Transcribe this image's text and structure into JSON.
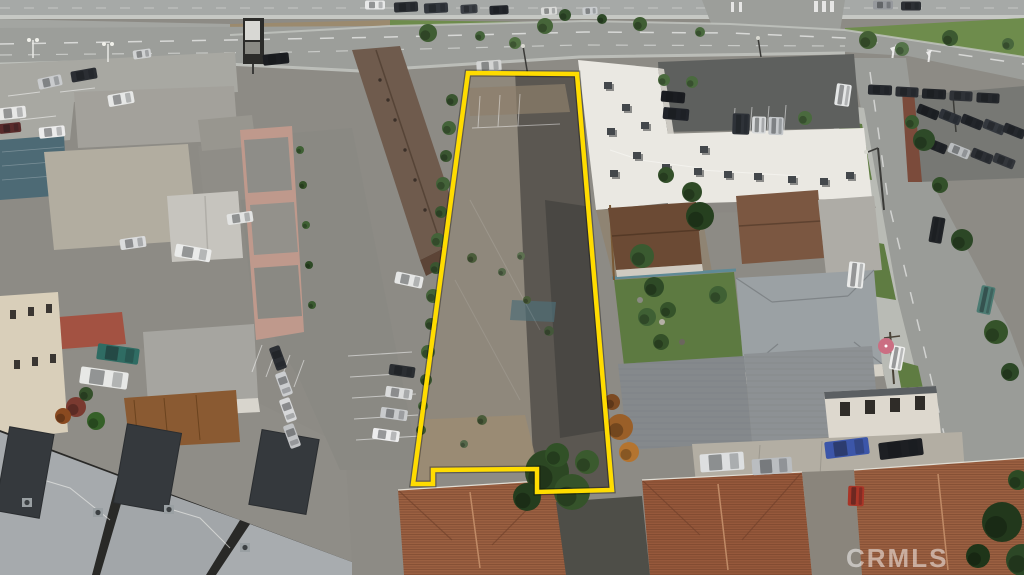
{
  "watermark": {
    "text": "CRMLS",
    "color": "#ffffff",
    "opacity": 0.5
  },
  "boundary": {
    "color": "#ffdc00",
    "width": 4.5,
    "points": "468,73 577,74 612,490 537,492 537,469 433,470 433,484 413,484"
  },
  "palette": {
    "boundary_yellow": "#ffdc00",
    "lot_surface": "#8f887c",
    "lot_dark_stain": "#55524c",
    "boulevard_asphalt": "#9c9e9a",
    "grass_green": "#6e8c4c",
    "white_roof": "#eae8e2",
    "tile_roof_terracotta": "#9b6041",
    "brown_apartment_roof": "#6f5b4d",
    "modern_roof_gray": "#a6aaad",
    "solar_panel_charcoal": "#35393d"
  },
  "scene": {
    "cars": [
      {
        "x": 375,
        "y": 5,
        "w": 20,
        "h": 9,
        "r": 0,
        "c": "#e7e8e8"
      },
      {
        "x": 406,
        "y": 7,
        "w": 24,
        "h": 10,
        "r": -3,
        "c": "#2b2e33"
      },
      {
        "x": 436,
        "y": 8,
        "w": 24,
        "h": 10,
        "r": -3,
        "c": "#33373d"
      },
      {
        "x": 469,
        "y": 9,
        "w": 17,
        "h": 9,
        "r": -3,
        "c": "#3c4046"
      },
      {
        "x": 499,
        "y": 10,
        "w": 19,
        "h": 9,
        "r": -3,
        "c": "#24272c"
      },
      {
        "x": 549,
        "y": 11,
        "w": 16,
        "h": 8,
        "r": -3,
        "c": "#d9dad8"
      },
      {
        "x": 590,
        "y": 11,
        "w": 15,
        "h": 8,
        "r": -3,
        "c": "#c9ccce"
      },
      {
        "x": 883,
        "y": 5,
        "w": 20,
        "h": 9,
        "r": 0,
        "c": "#96999d"
      },
      {
        "x": 911,
        "y": 6,
        "w": 20,
        "h": 9,
        "r": 0,
        "c": "#2d3035"
      },
      {
        "x": 50,
        "y": 82,
        "w": 24,
        "h": 11,
        "r": -12,
        "c": "#c9cbcd"
      },
      {
        "x": 84,
        "y": 75,
        "w": 26,
        "h": 11,
        "r": -10,
        "c": "#2b2e33"
      },
      {
        "x": 121,
        "y": 99,
        "w": 26,
        "h": 12,
        "r": -10,
        "c": "#e6e7e6"
      },
      {
        "x": 12,
        "y": 113,
        "w": 28,
        "h": 12,
        "r": -6,
        "c": "#e8e8e7"
      },
      {
        "x": 10,
        "y": 128,
        "w": 22,
        "h": 10,
        "r": -6,
        "c": "#5a2b2b"
      },
      {
        "x": 52,
        "y": 132,
        "w": 26,
        "h": 11,
        "r": -6,
        "c": "#ececec"
      },
      {
        "x": 142,
        "y": 54,
        "w": 18,
        "h": 9,
        "r": -8,
        "c": "#d0d2d3"
      },
      {
        "x": 276,
        "y": 59,
        "w": 26,
        "h": 11,
        "r": -6,
        "c": "#1b1d21"
      },
      {
        "x": 489,
        "y": 66,
        "w": 25,
        "h": 11,
        "r": -4,
        "c": "#d3d4d3"
      },
      {
        "x": 843,
        "y": 95,
        "w": 15,
        "h": 22,
        "r": 8,
        "c": "#e4e6e6"
      },
      {
        "x": 880,
        "y": 90,
        "w": 24,
        "h": 10,
        "r": 2,
        "c": "#26292e"
      },
      {
        "x": 907,
        "y": 92,
        "w": 23,
        "h": 10,
        "r": 3,
        "c": "#2b2e33"
      },
      {
        "x": 934,
        "y": 94,
        "w": 24,
        "h": 10,
        "r": 3,
        "c": "#222529"
      },
      {
        "x": 961,
        "y": 96,
        "w": 23,
        "h": 10,
        "r": 3,
        "c": "#2f3237"
      },
      {
        "x": 988,
        "y": 98,
        "w": 23,
        "h": 10,
        "r": 3,
        "c": "#25282c"
      },
      {
        "x": 928,
        "y": 112,
        "w": 22,
        "h": 10,
        "r": 22,
        "c": "#1e2125"
      },
      {
        "x": 950,
        "y": 117,
        "w": 22,
        "h": 10,
        "r": 22,
        "c": "#2e3238"
      },
      {
        "x": 972,
        "y": 122,
        "w": 22,
        "h": 10,
        "r": 22,
        "c": "#22252a"
      },
      {
        "x": 994,
        "y": 127,
        "w": 22,
        "h": 10,
        "r": 22,
        "c": "#34383e"
      },
      {
        "x": 1014,
        "y": 131,
        "w": 22,
        "h": 10,
        "r": 22,
        "c": "#25282d"
      },
      {
        "x": 936,
        "y": 146,
        "w": 22,
        "h": 10,
        "r": 22,
        "c": "#202327"
      },
      {
        "x": 959,
        "y": 151,
        "w": 22,
        "h": 10,
        "r": 22,
        "c": "#babdbf"
      },
      {
        "x": 982,
        "y": 156,
        "w": 22,
        "h": 10,
        "r": 22,
        "c": "#2c2f34"
      },
      {
        "x": 1004,
        "y": 161,
        "w": 22,
        "h": 10,
        "r": 22,
        "c": "#33363b"
      },
      {
        "x": 673,
        "y": 97,
        "w": 24,
        "h": 11,
        "r": 5,
        "c": "#1b1d21"
      },
      {
        "x": 676,
        "y": 114,
        "w": 26,
        "h": 12,
        "r": 5,
        "c": "#202329"
      },
      {
        "x": 741,
        "y": 124,
        "w": 17,
        "h": 21,
        "r": 2,
        "c": "#2e3238"
      },
      {
        "x": 759,
        "y": 125,
        "w": 14,
        "h": 17,
        "r": 2,
        "c": "#d8dadb"
      },
      {
        "x": 776,
        "y": 126,
        "w": 15,
        "h": 18,
        "r": 2,
        "c": "#c5c8cb"
      },
      {
        "x": 240,
        "y": 218,
        "w": 26,
        "h": 11,
        "r": -8,
        "c": "#e2e3e2"
      },
      {
        "x": 133,
        "y": 243,
        "w": 26,
        "h": 11,
        "r": -8,
        "c": "#dadbdc"
      },
      {
        "x": 193,
        "y": 253,
        "w": 36,
        "h": 13,
        "r": 10,
        "c": "#eaebea"
      },
      {
        "x": 409,
        "y": 280,
        "w": 28,
        "h": 12,
        "r": 12,
        "c": "#e5e6e5"
      },
      {
        "x": 402,
        "y": 371,
        "w": 26,
        "h": 11,
        "r": 8,
        "c": "#2b2e32"
      },
      {
        "x": 399,
        "y": 393,
        "w": 27,
        "h": 11,
        "r": 8,
        "c": "#dadbdb"
      },
      {
        "x": 394,
        "y": 414,
        "w": 27,
        "h": 11,
        "r": 8,
        "c": "#c8cacc"
      },
      {
        "x": 386,
        "y": 435,
        "w": 27,
        "h": 11,
        "r": 8,
        "c": "#ededee"
      },
      {
        "x": 118,
        "y": 354,
        "w": 42,
        "h": 16,
        "r": 8,
        "c": "#2f6c63"
      },
      {
        "x": 104,
        "y": 378,
        "w": 48,
        "h": 17,
        "r": 8,
        "c": "#e7e8e6"
      },
      {
        "x": 278,
        "y": 358,
        "w": 24,
        "h": 11,
        "r": 70,
        "c": "#2c2f34"
      },
      {
        "x": 284,
        "y": 384,
        "w": 24,
        "h": 11,
        "r": 70,
        "c": "#cbcdcf"
      },
      {
        "x": 288,
        "y": 410,
        "w": 24,
        "h": 11,
        "r": 70,
        "c": "#d7d8d9"
      },
      {
        "x": 292,
        "y": 436,
        "w": 24,
        "h": 11,
        "r": 70,
        "c": "#c0c2c4"
      },
      {
        "x": 937,
        "y": 230,
        "w": 13,
        "h": 26,
        "r": 10,
        "c": "#222528"
      },
      {
        "x": 986,
        "y": 300,
        "w": 14,
        "h": 28,
        "r": 12,
        "c": "#4c7b73"
      },
      {
        "x": 856,
        "y": 275,
        "w": 16,
        "h": 26,
        "r": 6,
        "c": "#e9eae9"
      },
      {
        "x": 897,
        "y": 358,
        "w": 13,
        "h": 24,
        "r": 10,
        "c": "#efefee"
      },
      {
        "x": 722,
        "y": 462,
        "w": 44,
        "h": 18,
        "r": -4,
        "c": "#dddfe0"
      },
      {
        "x": 772,
        "y": 466,
        "w": 40,
        "h": 16,
        "r": -4,
        "c": "#babdc0"
      },
      {
        "x": 847,
        "y": 448,
        "w": 44,
        "h": 17,
        "r": -7,
        "c": "#3c56a9"
      },
      {
        "x": 901,
        "y": 449,
        "w": 44,
        "h": 17,
        "r": -7,
        "c": "#1d1f23"
      },
      {
        "x": 856,
        "y": 496,
        "w": 16,
        "h": 20,
        "r": 2,
        "c": "#a93527"
      }
    ],
    "trees": [
      {
        "cx": 428,
        "cy": 33,
        "r": 9,
        "c": "#3f5d33"
      },
      {
        "cx": 545,
        "cy": 26,
        "r": 8,
        "c": "#466539"
      },
      {
        "cx": 515,
        "cy": 43,
        "r": 6,
        "c": "#527243"
      },
      {
        "cx": 640,
        "cy": 24,
        "r": 7,
        "c": "#3f5d33"
      },
      {
        "cx": 700,
        "cy": 32,
        "r": 5,
        "c": "#4a6a3e"
      },
      {
        "cx": 868,
        "cy": 40,
        "r": 9,
        "c": "#435f35"
      },
      {
        "cx": 902,
        "cy": 49,
        "r": 7,
        "c": "#55734a"
      },
      {
        "cx": 950,
        "cy": 38,
        "r": 8,
        "c": "#3c5931"
      },
      {
        "cx": 1008,
        "cy": 44,
        "r": 6,
        "c": "#48663c"
      },
      {
        "cx": 565,
        "cy": 15,
        "r": 6,
        "c": "#33502c"
      },
      {
        "cx": 602,
        "cy": 19,
        "r": 5,
        "c": "#2f4a28"
      },
      {
        "cx": 480,
        "cy": 36,
        "r": 5,
        "c": "#44633a"
      },
      {
        "cx": 452,
        "cy": 100,
        "r": 6,
        "c": "#3a5530"
      },
      {
        "cx": 449,
        "cy": 128,
        "r": 7,
        "c": "#446339"
      },
      {
        "cx": 446,
        "cy": 156,
        "r": 6,
        "c": "#3a5530"
      },
      {
        "cx": 443,
        "cy": 184,
        "r": 7,
        "c": "#446339"
      },
      {
        "cx": 441,
        "cy": 212,
        "r": 6,
        "c": "#3a5530"
      },
      {
        "cx": 438,
        "cy": 240,
        "r": 7,
        "c": "#446339"
      },
      {
        "cx": 436,
        "cy": 268,
        "r": 6,
        "c": "#3a5530"
      },
      {
        "cx": 433,
        "cy": 296,
        "r": 7,
        "c": "#446339"
      },
      {
        "cx": 431,
        "cy": 324,
        "r": 6,
        "c": "#3a5530"
      },
      {
        "cx": 428,
        "cy": 352,
        "r": 7,
        "c": "#446339"
      },
      {
        "cx": 426,
        "cy": 380,
        "r": 6,
        "c": "#3a5530"
      },
      {
        "cx": 423,
        "cy": 406,
        "r": 5,
        "c": "#446339"
      },
      {
        "cx": 421,
        "cy": 430,
        "r": 5,
        "c": "#3a5530"
      },
      {
        "cx": 472,
        "cy": 258,
        "r": 5,
        "c": "#4a5c3a"
      },
      {
        "cx": 502,
        "cy": 272,
        "r": 4,
        "c": "#55684a"
      },
      {
        "cx": 527,
        "cy": 300,
        "r": 4,
        "c": "#4a5c3a"
      },
      {
        "cx": 549,
        "cy": 331,
        "r": 5,
        "c": "#44573a"
      },
      {
        "cx": 482,
        "cy": 420,
        "r": 5,
        "c": "#4a5c3a"
      },
      {
        "cx": 464,
        "cy": 444,
        "r": 4,
        "c": "#55684a"
      },
      {
        "cx": 521,
        "cy": 256,
        "r": 4,
        "c": "#5d7050"
      },
      {
        "cx": 547,
        "cy": 472,
        "r": 22,
        "c": "#2c4723"
      },
      {
        "cx": 572,
        "cy": 492,
        "r": 18,
        "c": "#35532a"
      },
      {
        "cx": 527,
        "cy": 497,
        "r": 14,
        "c": "#243d1e"
      },
      {
        "cx": 587,
        "cy": 462,
        "r": 12,
        "c": "#3a5a2e"
      },
      {
        "cx": 557,
        "cy": 455,
        "r": 12,
        "c": "#315127"
      },
      {
        "cx": 620,
        "cy": 427,
        "r": 13,
        "c": "#9a5f28"
      },
      {
        "cx": 629,
        "cy": 452,
        "r": 10,
        "c": "#b4742f"
      },
      {
        "cx": 612,
        "cy": 402,
        "r": 8,
        "c": "#7c4a22"
      },
      {
        "cx": 642,
        "cy": 256,
        "r": 12,
        "c": "#3a5a30"
      },
      {
        "cx": 654,
        "cy": 287,
        "r": 10,
        "c": "#2e4a26"
      },
      {
        "cx": 647,
        "cy": 317,
        "r": 9,
        "c": "#3f6034"
      },
      {
        "cx": 661,
        "cy": 342,
        "r": 8,
        "c": "#345028"
      },
      {
        "cx": 700,
        "cy": 216,
        "r": 14,
        "c": "#26401f"
      },
      {
        "cx": 692,
        "cy": 192,
        "r": 10,
        "c": "#2e4a26"
      },
      {
        "cx": 666,
        "cy": 175,
        "r": 8,
        "c": "#33502a"
      },
      {
        "cx": 924,
        "cy": 140,
        "r": 11,
        "c": "#2e4a28"
      },
      {
        "cx": 912,
        "cy": 122,
        "r": 7,
        "c": "#3a5a30"
      },
      {
        "cx": 962,
        "cy": 240,
        "r": 11,
        "c": "#2c4726"
      },
      {
        "cx": 996,
        "cy": 332,
        "r": 12,
        "c": "#35532a"
      },
      {
        "cx": 1010,
        "cy": 372,
        "r": 9,
        "c": "#2c4726"
      },
      {
        "cx": 940,
        "cy": 185,
        "r": 8,
        "c": "#33502a"
      },
      {
        "cx": 1002,
        "cy": 522,
        "r": 20,
        "c": "#22381c"
      },
      {
        "cx": 1022,
        "cy": 560,
        "r": 16,
        "c": "#2c4726"
      },
      {
        "cx": 978,
        "cy": 556,
        "r": 12,
        "c": "#1f3519"
      },
      {
        "cx": 1018,
        "cy": 480,
        "r": 10,
        "c": "#2c4a24"
      },
      {
        "cx": 76,
        "cy": 407,
        "r": 10,
        "c": "#7a3a30"
      },
      {
        "cx": 96,
        "cy": 421,
        "r": 9,
        "c": "#356028"
      },
      {
        "cx": 63,
        "cy": 416,
        "r": 8,
        "c": "#8a4a20"
      },
      {
        "cx": 86,
        "cy": 394,
        "r": 7,
        "c": "#35502b"
      },
      {
        "cx": 664,
        "cy": 80,
        "r": 6,
        "c": "#4a6a3e"
      },
      {
        "cx": 692,
        "cy": 82,
        "r": 6,
        "c": "#4a6a3e"
      },
      {
        "cx": 805,
        "cy": 118,
        "r": 7,
        "c": "#4a6a3e"
      },
      {
        "cx": 300,
        "cy": 150,
        "r": 4,
        "c": "#3f6034"
      },
      {
        "cx": 303,
        "cy": 185,
        "r": 4,
        "c": "#345028"
      },
      {
        "cx": 306,
        "cy": 225,
        "r": 4,
        "c": "#3f6034"
      },
      {
        "cx": 309,
        "cy": 265,
        "r": 4,
        "c": "#2e4a26"
      },
      {
        "cx": 312,
        "cy": 305,
        "r": 4,
        "c": "#3a5a30"
      },
      {
        "cx": 718,
        "cy": 295,
        "r": 9,
        "c": "#3f6034"
      },
      {
        "cx": 668,
        "cy": 310,
        "r": 8,
        "c": "#35532a"
      }
    ],
    "rooftop_units": [
      {
        "x": 604,
        "y": 82
      },
      {
        "x": 622,
        "y": 104
      },
      {
        "x": 641,
        "y": 122
      },
      {
        "x": 607,
        "y": 128
      },
      {
        "x": 633,
        "y": 152
      },
      {
        "x": 662,
        "y": 164
      },
      {
        "x": 694,
        "y": 168
      },
      {
        "x": 724,
        "y": 171
      },
      {
        "x": 754,
        "y": 173
      },
      {
        "x": 788,
        "y": 176
      },
      {
        "x": 820,
        "y": 178
      },
      {
        "x": 846,
        "y": 172
      },
      {
        "x": 610,
        "y": 170
      },
      {
        "x": 700,
        "y": 146
      }
    ],
    "solar_panels": [
      {
        "x": 2,
        "y": 430,
        "w": 45,
        "h": 85,
        "r": 10
      },
      {
        "x": 120,
        "y": 428,
        "w": 55,
        "h": 80,
        "r": 10
      },
      {
        "x": 255,
        "y": 434,
        "w": 58,
        "h": 76,
        "r": 10
      }
    ],
    "ac_units": [
      {
        "x": 22,
        "y": 498
      },
      {
        "x": 93,
        "y": 508
      },
      {
        "x": 164,
        "y": 505
      },
      {
        "x": 240,
        "y": 543
      }
    ],
    "umbrella": {
      "cx": 886,
      "cy": 346,
      "r": 8,
      "c": "#cb6e82"
    }
  }
}
